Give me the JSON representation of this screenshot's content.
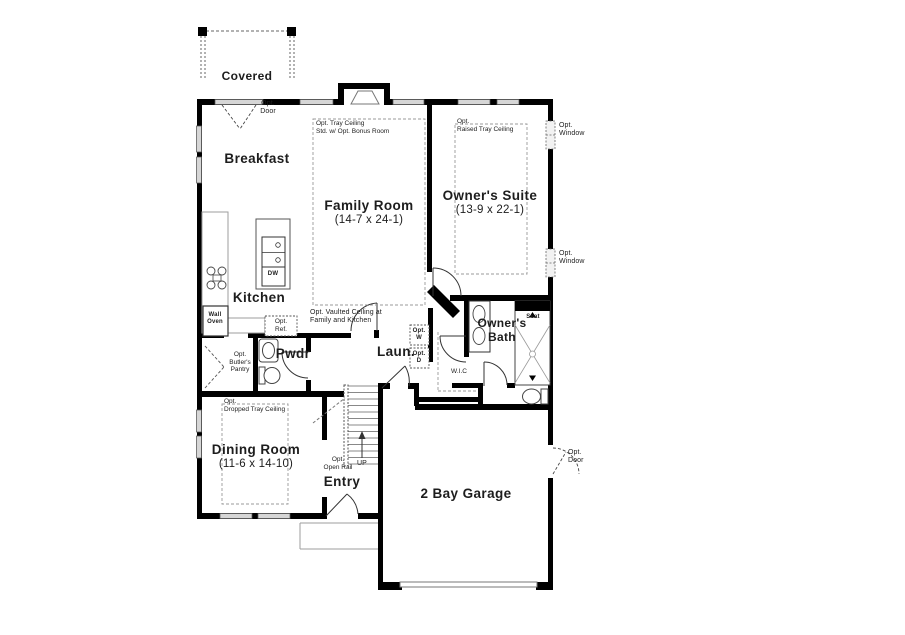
{
  "rooms": {
    "covered_porch": {
      "name": "Covered"
    },
    "breakfast": {
      "name": "Breakfast"
    },
    "family_room": {
      "name": "Family Room",
      "dims": "(14-7 x 24-1)",
      "note1": "Opt. Tray Ceiling",
      "note2": "Std. w/ Opt. Bonus Room"
    },
    "owners_suite": {
      "name": "Owner's Suite",
      "dims": "(13-9 x 22-1)",
      "note1": "Opt.",
      "note2": "Raised Tray Ceiling"
    },
    "kitchen": {
      "name": "Kitchen"
    },
    "pwdr": {
      "name": "Pwdr"
    },
    "butlers_pantry": {
      "note1": "Opt.",
      "note2": "Butler's",
      "note3": "Pantry"
    },
    "dining_room": {
      "name": "Dining Room",
      "dims": "(11-6 x 14-10)",
      "note1": "Opt.",
      "note2": "Dropped Tray Ceiling"
    },
    "entry": {
      "name": "Entry"
    },
    "laundry": {
      "name": "Laun."
    },
    "wic": {
      "name": "W.I.C"
    },
    "owners_bath": {
      "name1": "Owner's",
      "name2": "Bath"
    },
    "garage": {
      "name": "2 Bay Garage"
    }
  },
  "labels": {
    "opt_door_breakfast": {
      "l1": "Opt.",
      "l2": "Door"
    },
    "opt_window_upper": {
      "l1": "Opt.",
      "l2": "Window"
    },
    "opt_window_lower": {
      "l1": "Opt.",
      "l2": "Window"
    },
    "opt_door_garage": {
      "l1": "Opt.",
      "l2": "Door"
    },
    "vaulted": {
      "l1": "Opt. Vaulted Ceiling at",
      "l2": "Family and Kitchen"
    },
    "wall_oven": {
      "l1": "Wall",
      "l2": "Oven"
    },
    "opt_ref": {
      "l1": "Opt.",
      "l2": "Ref."
    },
    "opt_washer": {
      "l1": "Opt.",
      "l2": "W"
    },
    "opt_dryer": {
      "l1": "Opt.",
      "l2": "D"
    },
    "dw": "DW",
    "up": "UP",
    "open_rail": {
      "l1": "Opt.",
      "l2": "Open Rail"
    },
    "seat": "Seat"
  },
  "colors": {
    "wall": "#000000",
    "window_fill": "#d6d6d6",
    "text": "#1d1d1d",
    "dashed_line": "#777777",
    "light_line": "#9e9e9e"
  }
}
